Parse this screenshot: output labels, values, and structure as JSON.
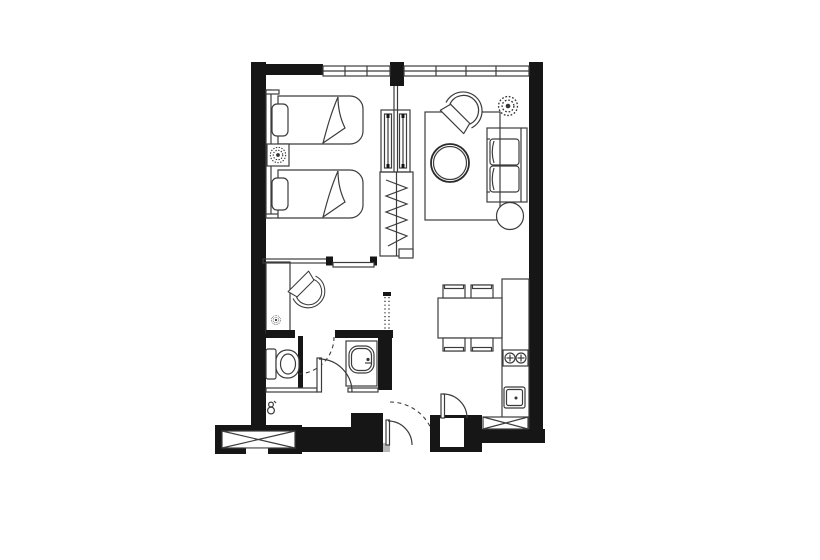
{
  "meta": {
    "title": "Apartment floor plan",
    "drawing_type": "architectural floor plan, black and white line drawing",
    "canvas": {
      "width": 820,
      "height": 560
    }
  },
  "colors": {
    "background": "#ffffff",
    "wall": "#161616",
    "line": "#3c3c3c",
    "threshold_grey": "#b7b7b7"
  },
  "rooms": {
    "bedroom": "Bedroom with two twin beds",
    "living": "Living room with sofa and round coffee table",
    "hall": "Hall with desk and chair",
    "bathroom": "Bathroom with toilet and washbasin",
    "kitchen": "Kitchen with counter, stove and sink",
    "dining": "Dining area with table and four chairs",
    "entry": "Entry vestibule with swing doors"
  },
  "furniture": {
    "bed_1": "twin bed with pillow and folded blanket",
    "bed_2": "twin bed with pillow and folded blanket",
    "nightstand": "bedside table with plant",
    "headboard": "headboard panel along wall",
    "glass_partition": "double sliding glass panel partition",
    "wardrobe": "wardrobe with hanging rail (zigzag hatch)",
    "sliding_door": "sliding door between bedroom and hall",
    "desk": "built-in desk",
    "desk_chair": "round-back tub chair",
    "lounge_chair": "round-back tub chair",
    "coffee_table": "round coffee table",
    "sofa": "two-seat sofa against east wall",
    "ottoman": "round side table",
    "rug": "area rug",
    "plant_large_1": "potted plant (bedroom)",
    "plant_large_2": "potted plant (living room)",
    "plant_small": "small plant (hall)",
    "toilet": "toilet with cistern",
    "washbasin": "washbasin on counter",
    "dining_table": "rectangular dining table",
    "dining_chairs": "four dining chairs",
    "stove": "two-burner cooktop",
    "kitchen_sink": "square kitchen sink",
    "shaft_left": "service shaft / AC ledge (cross-hatched)",
    "shaft_right": "service shaft (cross-hatched)"
  },
  "doors": {
    "bathroom_door": "swing door into washbasin area",
    "toilet_door_swing": "dashed swing arc at toilet compartment",
    "entry_door": "entrance door with dashed swing arc",
    "kitchen_door": "swing door at kitchen passage"
  },
  "windows": {
    "north_window_left": "window band with 2 mullions",
    "north_window_right": "window band with 3 mullions"
  }
}
